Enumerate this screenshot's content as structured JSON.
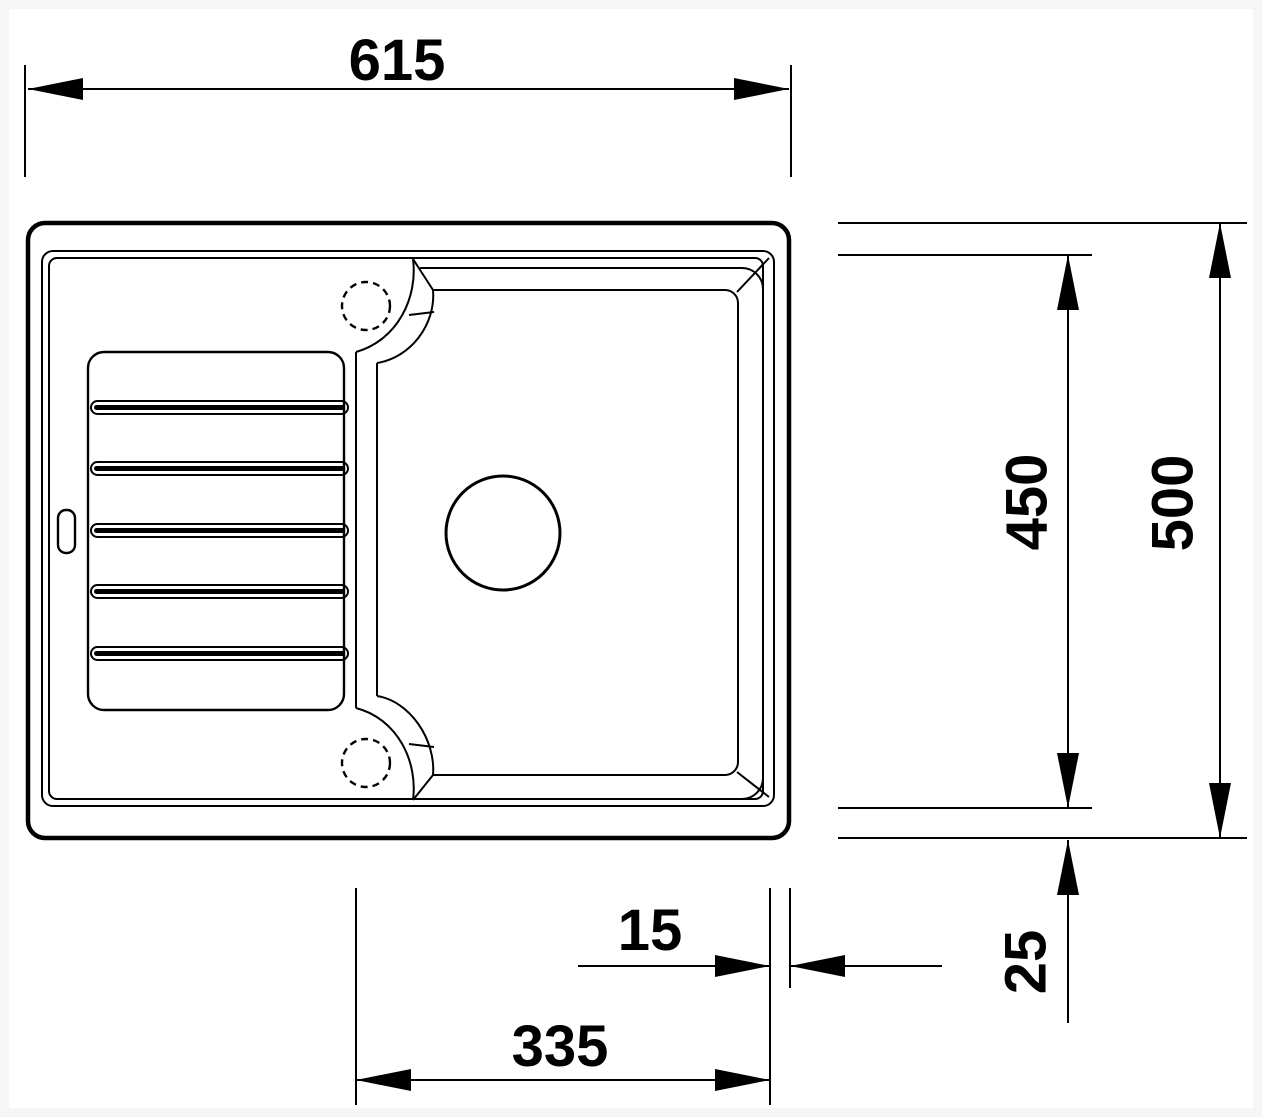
{
  "drawing": {
    "subject": "kitchen-sink-top-view-technical-drawing",
    "background_color": "#ffffff",
    "line_color": "#000000",
    "labels": {
      "overall_width": "615",
      "inner_depth": "450",
      "overall_depth": "500",
      "right_rim_offset": "15",
      "bowl_width": "335",
      "bottom_rim_offset": "25"
    }
  }
}
